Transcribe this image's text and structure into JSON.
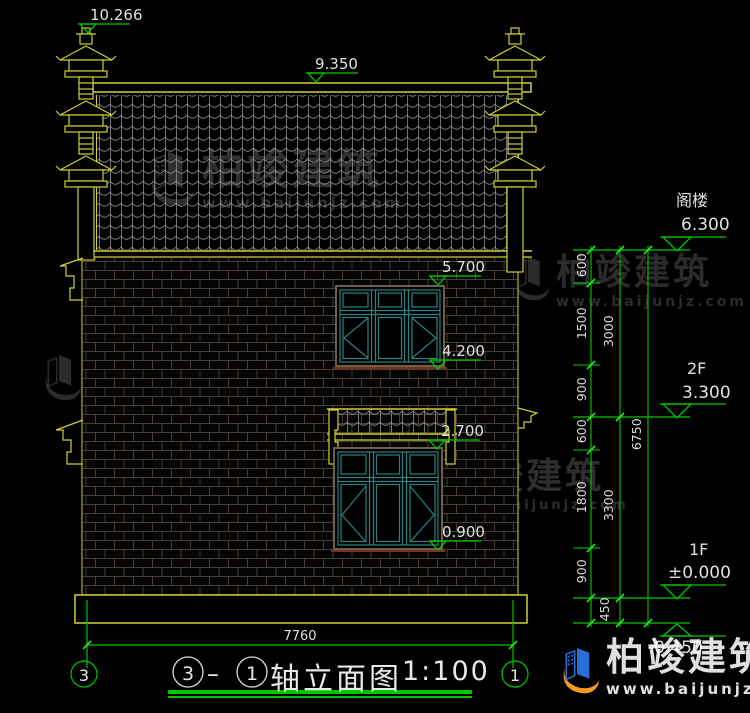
{
  "colors": {
    "cad_yellow": "#cfcf35",
    "cad_green": "#00c800",
    "window_teal": "#2f8080",
    "tile_gray": "#8d8d8d",
    "mortar_brown": "#4a3e34",
    "frame_brown": "#6e5f4b",
    "sill_red": "#7c2f1d",
    "text_white": "#e0e0e0",
    "logo_blue": "#2a6fd6",
    "logo_orange": "#f59a1e"
  },
  "markers": {
    "roof_finial": "10.266",
    "ridge": "9.350",
    "upper_window_top": "5.700",
    "upper_window_sill": "4.200",
    "canopy": "2.700",
    "lower_window_sill": "0.900"
  },
  "levels": [
    {
      "label": "阁楼",
      "value": "6.300"
    },
    {
      "label": "2F",
      "value": "3.300"
    },
    {
      "label": "1F",
      "value": "±0.000"
    },
    {
      "label": "",
      "value": "-0.450"
    }
  ],
  "dims": {
    "inner": [
      "600",
      "1500",
      "900",
      "600",
      "1800",
      "900",
      "450"
    ],
    "middle": [
      "3000",
      "3300"
    ],
    "overall_height": "6750",
    "overall_width": "7760"
  },
  "axes": {
    "left": "3",
    "right": "1"
  },
  "title": {
    "axis_from": "3",
    "dash": "–",
    "axis_to": "1",
    "text": "轴立面图",
    "scale": "1:100"
  },
  "watermark": {
    "brand": "柏竣建筑",
    "url": "www.baijunjz.com"
  }
}
